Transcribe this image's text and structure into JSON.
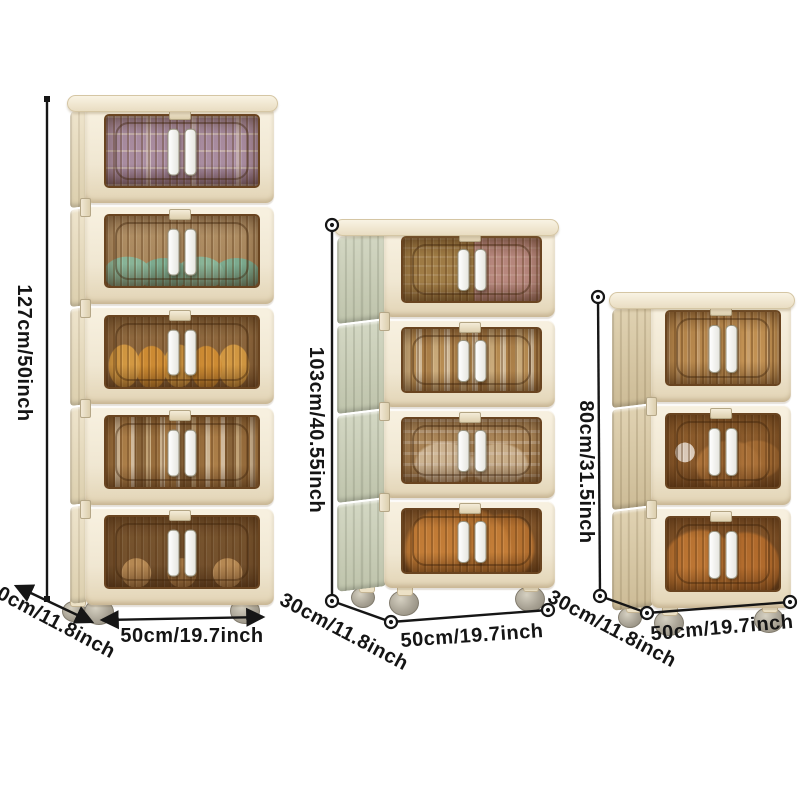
{
  "image": {
    "type": "product-dimension-photo",
    "background": "#ffffff",
    "line_color": "#161616",
    "label_color": "#151515"
  },
  "product": {
    "body_color": "#f2ebd8",
    "door_tint_color": "#a97843",
    "handle_color": "#ffffff",
    "cabinets": [
      {
        "name": "five-tier-cabinet",
        "tiers": 5,
        "height_label": "127cm/50inch",
        "depth_label": "30cm/11.8inch",
        "width_label": "50cm/19.7inch",
        "side_color": "#eee4cc",
        "tier_contents": [
          "purple-trays",
          "teal-bowls",
          "orange-snacks",
          "books",
          "plush-toys"
        ]
      },
      {
        "name": "four-tier-cabinet",
        "tiers": 4,
        "height_label": "103cm/40.55inch",
        "depth_label": "30cm/11.8inch",
        "width_label": "50cm/19.7inch",
        "side_color": "#d0d4c0",
        "tier_contents": [
          "olive-pink",
          "cream-books",
          "dishes",
          "orange-bag"
        ]
      },
      {
        "name": "three-tier-cabinet",
        "tiers": 3,
        "height_label": "80cm/31.5inch",
        "depth_label": "30cm/11.8inch",
        "width_label": "50cm/19.7inch",
        "side_color": "#dccdab",
        "tier_contents": [
          "tan-items",
          "brown-dishes",
          "orange-bags"
        ]
      }
    ]
  }
}
